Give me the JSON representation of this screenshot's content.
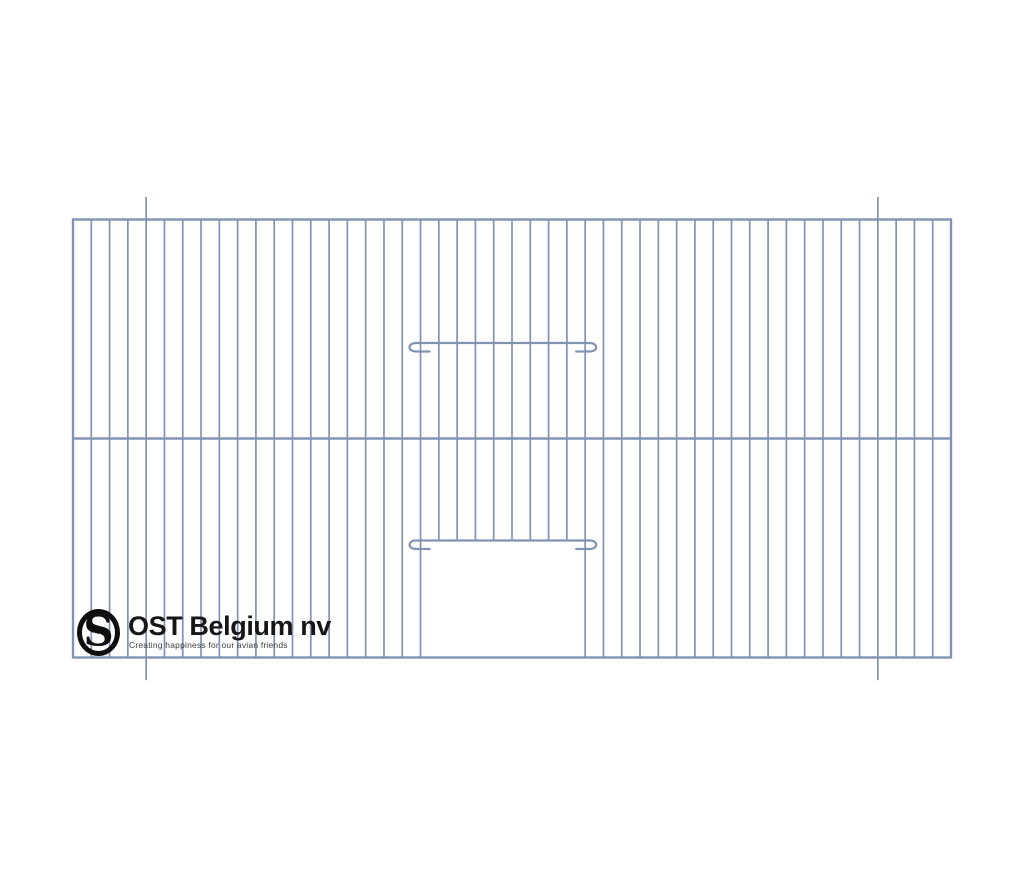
{
  "page": {
    "background": "#ffffff",
    "description": "Technical line drawing of a wire cage front panel with sliding door, by OST Belgium nv"
  },
  "logo": {
    "title": "OST Belgium nv",
    "tagline": "Creating happiness for our avian friends",
    "monogram": {
      "s": "S",
      "t": "T"
    },
    "ink_color": "#0e0e0e"
  },
  "diagram": {
    "type": "cage-front-panel",
    "wire_color": "#8093b3",
    "bar_stroke_width": 1.7,
    "frame_stroke_width": 2.4,
    "slider_stroke_width": 2.2,
    "frame": {
      "left": 73,
      "top": 219.5,
      "right": 951,
      "bottom": 657.5
    },
    "intervals": 48,
    "middle_rail_y": 438.5,
    "door": {
      "left_bar_index": 19,
      "right_bar_index": 28,
      "top_y": 540.5
    },
    "sliders": [
      {
        "y": 343,
        "left_bar_index": 19,
        "right_bar_index": 28,
        "hook_drop": 8.5,
        "hook_rx": 6,
        "overshoot": 5,
        "stub": 9
      },
      {
        "y": 540.5,
        "left_bar_index": 19,
        "right_bar_index": 28,
        "hook_drop": 8.5,
        "hook_rx": 6,
        "overshoot": 5,
        "stub": 9
      }
    ],
    "protruding_bars": {
      "indices": [
        4,
        44
      ],
      "extension": 22
    }
  }
}
